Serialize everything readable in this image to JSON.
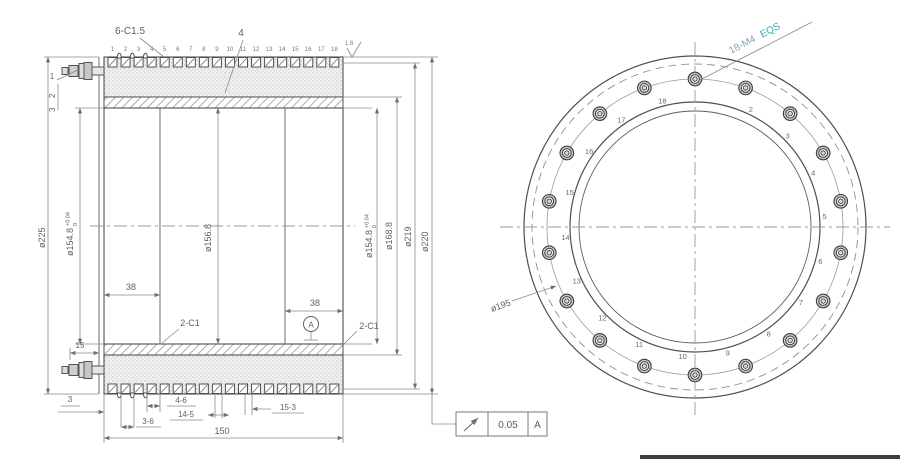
{
  "left_view": {
    "callout_chamfer": "6-C1.5",
    "callout_body": "4",
    "surface_finish": "1.6",
    "part_callout_1": "1",
    "part_callout_2": "2",
    "part_callout_3": "3",
    "slot_numbers": [
      "1",
      "2",
      "3",
      "4",
      "5",
      "6",
      "7",
      "8",
      "9",
      "10",
      "11",
      "12",
      "13",
      "14",
      "15",
      "16",
      "17",
      "18"
    ],
    "dims": {
      "od": "ø225",
      "bore_left": "ø154.8",
      "bore_center": "ø156.8",
      "bore_right": "ø154.8",
      "tol_up": "+0.04",
      "tol_dn": "0",
      "groove": "ø168.8",
      "slot_root": "ø219",
      "slot_od": "ø220",
      "step_left": "38",
      "step_right": "38",
      "chamfer_left": "2-C1",
      "chamfer_right": "2-C1",
      "datum": "A",
      "bolt_offset": "15",
      "slot_offset": "3",
      "pitch_a": "4-6",
      "pitch_b": "3-6",
      "pitch_c": "14-5",
      "pitch_d": "15-3",
      "length": "150"
    },
    "fcf": {
      "symbol": "circular-runout",
      "tolerance": "0.05",
      "datum": "A"
    }
  },
  "right_view": {
    "thread_spec": "18-M4",
    "thread_suffix": "EQS",
    "bolt_circle_dim": "ø195",
    "hole_labels": [
      "",
      "2",
      "3",
      "4",
      "5",
      "6",
      "7",
      "8",
      "9",
      "10",
      "11",
      "12",
      "13",
      "14",
      "15",
      "16",
      "17",
      "18"
    ]
  },
  "colors": {
    "line": "#4f4f4f",
    "dim": "#8a8a8a",
    "teal_spec": "#7fa6ab",
    "teal_suffix": "#2fa9bc",
    "bar": "#3f3f3f"
  }
}
